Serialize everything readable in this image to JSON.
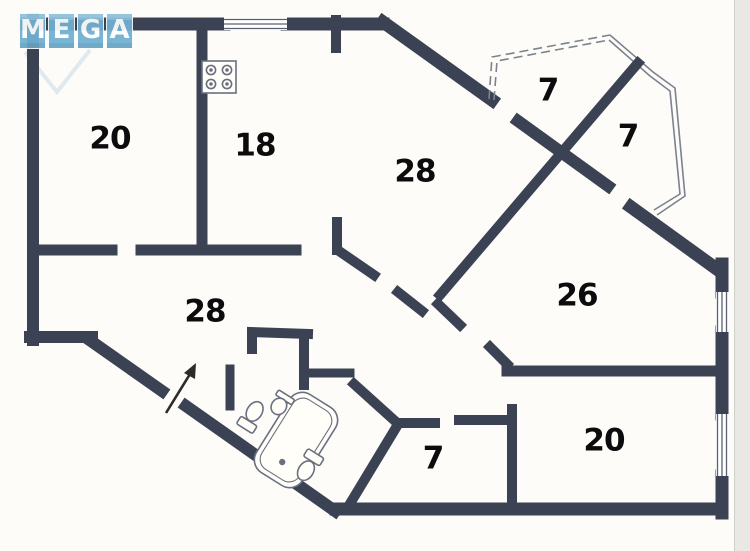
{
  "document": {
    "type": "apartment floor plan",
    "background_color": "#fdfcf8",
    "wall_color": "#3a4254",
    "fixture_outline_color": "#6b7080"
  },
  "watermark": {
    "text": "MEGA",
    "letters": [
      "M",
      "E",
      "G",
      "A"
    ],
    "bg_color": "#6fb0d2",
    "text_color": "#ffffff"
  },
  "rooms": [
    {
      "name": "room-top-left",
      "label": "20"
    },
    {
      "name": "kitchen",
      "label": "18"
    },
    {
      "name": "living-room",
      "label": "28"
    },
    {
      "name": "balcony-left",
      "label": "7"
    },
    {
      "name": "balcony-right",
      "label": "7"
    },
    {
      "name": "room-right",
      "label": "26"
    },
    {
      "name": "hallway",
      "label": "28"
    },
    {
      "name": "storage-room",
      "label": "7"
    },
    {
      "name": "room-bottom-right",
      "label": "20"
    }
  ],
  "icons": [
    {
      "name": "stove-icon",
      "meaning": "4-burner kitchen stove"
    },
    {
      "name": "bathtub-icon",
      "meaning": "bathtub"
    },
    {
      "name": "toilet-icon",
      "meaning": "toilet"
    },
    {
      "name": "sink-icon",
      "meaning": "wash basin"
    },
    {
      "name": "wc-toilet-icon",
      "meaning": "toilet in WC"
    },
    {
      "name": "entrance-arrow-icon",
      "meaning": "apartment entrance direction"
    },
    {
      "name": "window-icon",
      "meaning": "window (double line)"
    },
    {
      "name": "bay-window-icon",
      "meaning": "bay window / loggia glazing"
    }
  ]
}
